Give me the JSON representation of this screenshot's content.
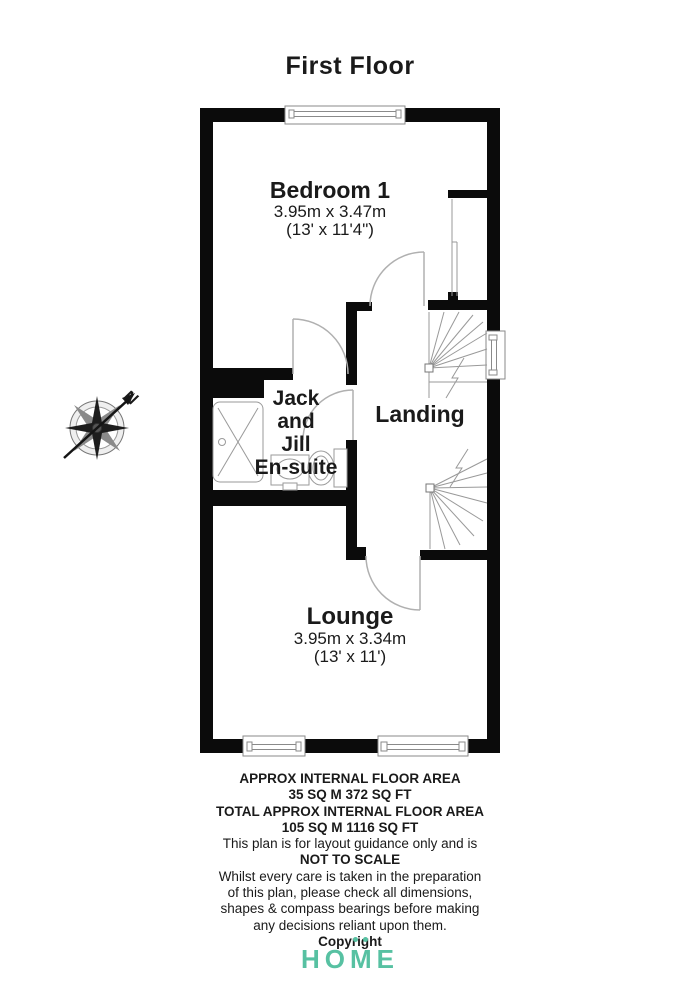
{
  "page": {
    "title": "First Floor"
  },
  "compass": {
    "north_label": "N"
  },
  "rooms": {
    "bedroom": {
      "name": "Bedroom 1",
      "size_metric": "3.95m x 3.47m",
      "size_imperial": "(13' x 11'4\")"
    },
    "ensuite": {
      "name_line1": "Jack",
      "name_line2": "and",
      "name_line3": "Jill",
      "name_line4": "En-suite"
    },
    "landing": {
      "name": "Landing"
    },
    "lounge": {
      "name": "Lounge",
      "size_metric": "3.95m x 3.34m",
      "size_imperial": "(13' x 11')"
    }
  },
  "disclaimer": {
    "lines": [
      "APPROX INTERNAL FLOOR AREA",
      "35 SQ M 372 SQ FT",
      "TOTAL APPROX INTERNAL FLOOR AREA",
      "105 SQ M 1116 SQ FT",
      "This plan is for layout guidance only and is",
      "NOT TO SCALE",
      "Whilst every care is taken in the preparation",
      "of this plan, please check all dimensions,",
      "shapes & compass bearings before making",
      "any decisions reliant upon them.",
      "Copyright"
    ]
  },
  "logo": {
    "text": "HOME",
    "color": "#57c1a2"
  },
  "colors": {
    "wall": "#0b0b0b",
    "fixture_line": "#999999",
    "door_line": "#b0b0b0",
    "text": "#1a1a1a"
  }
}
